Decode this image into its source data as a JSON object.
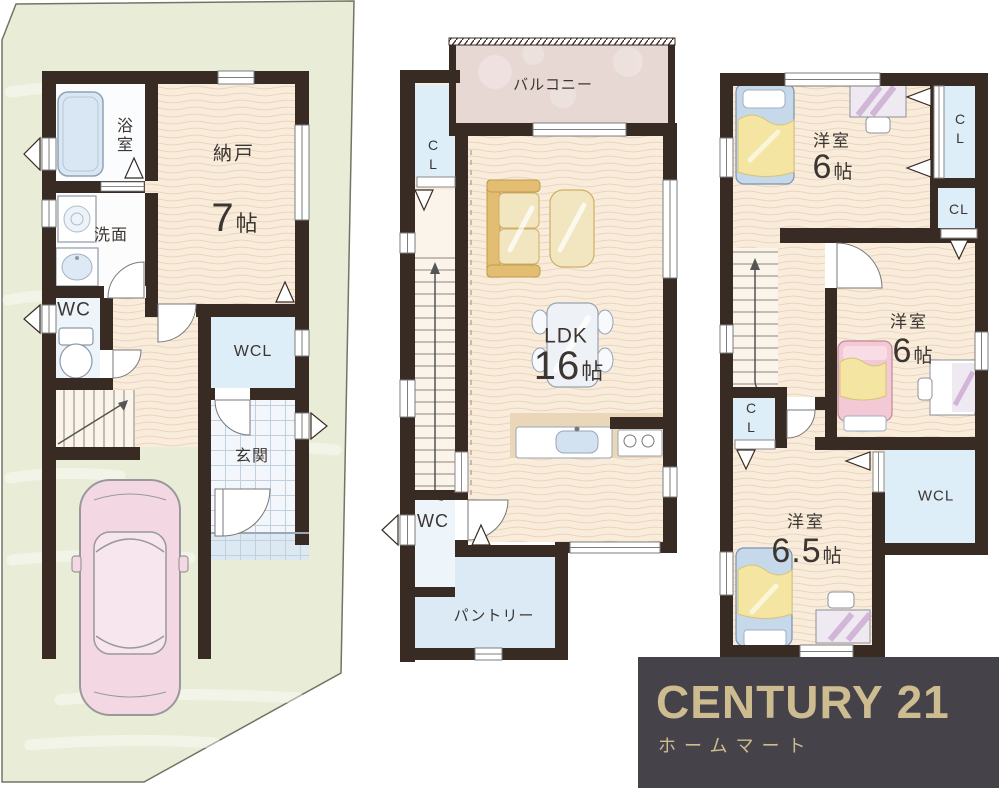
{
  "floor1": {
    "bath": "浴室",
    "washroom": "洗面",
    "wc": "WC",
    "storage": "納戸",
    "storage_size": {
      "num": "7",
      "unit": "帖"
    },
    "closet": "WCL",
    "entrance": "玄関"
  },
  "floor2": {
    "balcony": "バルコニー",
    "closet": "CL",
    "ldk": "LDK",
    "ldk_size": {
      "num": "16",
      "unit": "帖"
    },
    "wc": "WC",
    "pantry": "パントリー"
  },
  "floor3": {
    "room_top": "洋室",
    "room_top_size": {
      "num": "6",
      "unit": "帖"
    },
    "closet_top": "CL",
    "closet_mid": "CL",
    "room_mid": "洋室",
    "room_mid_size": {
      "num": "6",
      "unit": "帖"
    },
    "closet_left": "CL",
    "wcl": "WCL",
    "room_bottom": "洋室",
    "room_bottom_size": {
      "num": "6.5",
      "unit": "帖"
    }
  },
  "logo": {
    "brand": "CENTURY 21",
    "company": "ホームマート"
  },
  "colors": {
    "wall": "#382b24",
    "floor_cream": "#f9ecdb",
    "floor_wave": "#ead5bf",
    "site_green": "#e9edd8",
    "closet_blue": "#ddeef8",
    "balcony_pink": "#e7d8d4",
    "car_pink": "#f3d8e3",
    "logo_bg": "#454349",
    "logo_gold": "#cdbc90",
    "text": "#3b3632"
  }
}
